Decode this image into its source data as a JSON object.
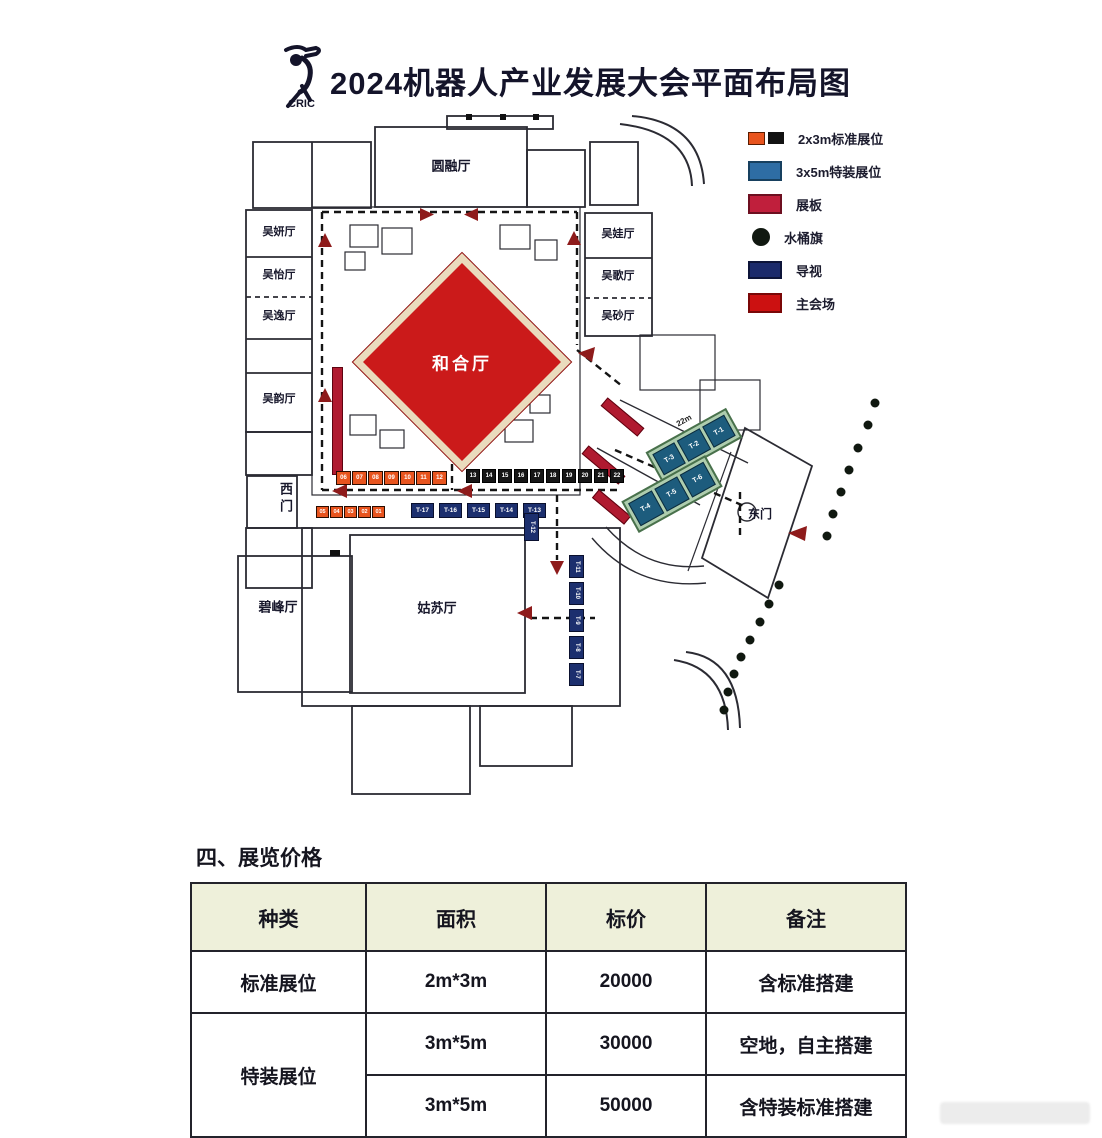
{
  "header": {
    "logo_text": "CRIC",
    "title": "2024机器人产业发展大会平面布局图"
  },
  "legend": {
    "items": [
      {
        "label": "2x3m标准展位",
        "colors": [
          "#e8541e",
          "#121212"
        ]
      },
      {
        "label": "3x5m特装展位",
        "color": "#2e6da4"
      },
      {
        "label": "展板",
        "color": "#c01f3c"
      },
      {
        "label": "水桶旗",
        "color": "#101810"
      },
      {
        "label": "导视",
        "color": "#1b2a6b"
      },
      {
        "label": "主会场",
        "color": "#cc1111"
      }
    ]
  },
  "floorplan": {
    "halls": {
      "yuanrong": "圆融厅",
      "hehe": "和合厅",
      "gusu": "姑苏厅",
      "bifeng": "碧峰厅",
      "left": [
        "吴妍厅",
        "吴怡厅",
        "吴逸厅",
        "吴韵厅"
      ],
      "right": [
        "吴娃厅",
        "吴歌厅",
        "吴砂厅"
      ]
    },
    "gates": {
      "west": "西门",
      "east": "东门"
    },
    "booths": {
      "orange_row": [
        "06",
        "07",
        "08",
        "09",
        "10",
        "11",
        "12"
      ],
      "black_row": [
        "13",
        "14",
        "15",
        "16",
        "17",
        "18",
        "19",
        "20",
        "21",
        "22"
      ],
      "orange_row2": [
        "05",
        "04",
        "03",
        "02",
        "01"
      ],
      "t_row": [
        "T-17",
        "T-16",
        "T-15",
        "T-14",
        "T-13"
      ],
      "t12": "T-12",
      "t_vertical": [
        "T-11",
        "T-10",
        "T-9",
        "T-8",
        "T-7"
      ],
      "special_row1": [
        "T-3",
        "T-2",
        "T-1"
      ],
      "special_row2": [
        "T-4",
        "T-5",
        "T-6"
      ]
    },
    "dimension_label": "22m"
  },
  "pricing": {
    "section_title": "四、展览价格",
    "table": {
      "headers": [
        "种类",
        "面积",
        "标价",
        "备注"
      ],
      "rows": [
        {
          "type": "标准展位",
          "area": "2m*3m",
          "price": "20000",
          "note": "含标准搭建"
        },
        {
          "type": "特装展位",
          "area": "3m*5m",
          "price": "30000",
          "note": "空地，自主搭建"
        },
        {
          "type": "",
          "area": "3m*5m",
          "price": "50000",
          "note": "含特装标准搭建"
        }
      ]
    }
  }
}
